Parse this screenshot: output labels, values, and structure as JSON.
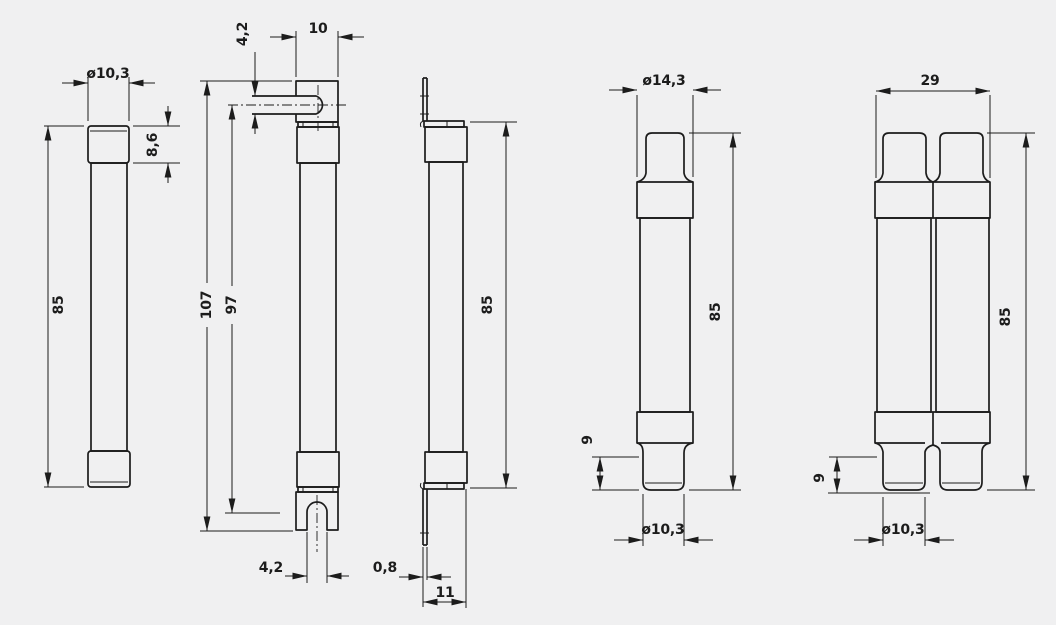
{
  "canvas": {
    "background": "#f0f0f1",
    "line_color": "#1c1c1c",
    "drawing_type": "technical dimension drawing, 5 fuse-link views"
  },
  "figures": {
    "fig1": {
      "name": "cylindrical fuse-link, front view",
      "dims": {
        "diameter": "ø10,3",
        "cap_height": "8,6",
        "length": "85"
      }
    },
    "fig2": {
      "name": "fuse-link with slotted bolt tags, front view",
      "dims": {
        "slot_width": "4,2",
        "tag_width": "10",
        "overall_length": "107",
        "slot_centers": "97",
        "bottom_slot_width": "4,2"
      }
    },
    "fig3": {
      "name": "fuse-link with bolt tags, side view",
      "dims": {
        "length": "85",
        "tag_thickness": "0,8",
        "tag_depth": "11"
      }
    },
    "fig4": {
      "name": "fuse-link with striker cap, front view",
      "dims": {
        "cap_diameter": "ø14,3",
        "length": "85",
        "tip_length": "9",
        "tip_diameter": "ø10,3"
      }
    },
    "fig5": {
      "name": "twin fuse-link, front view",
      "dims": {
        "overall_width": "29",
        "length": "85",
        "tip_length": "9",
        "tip_diameter": "ø10,3"
      }
    }
  }
}
